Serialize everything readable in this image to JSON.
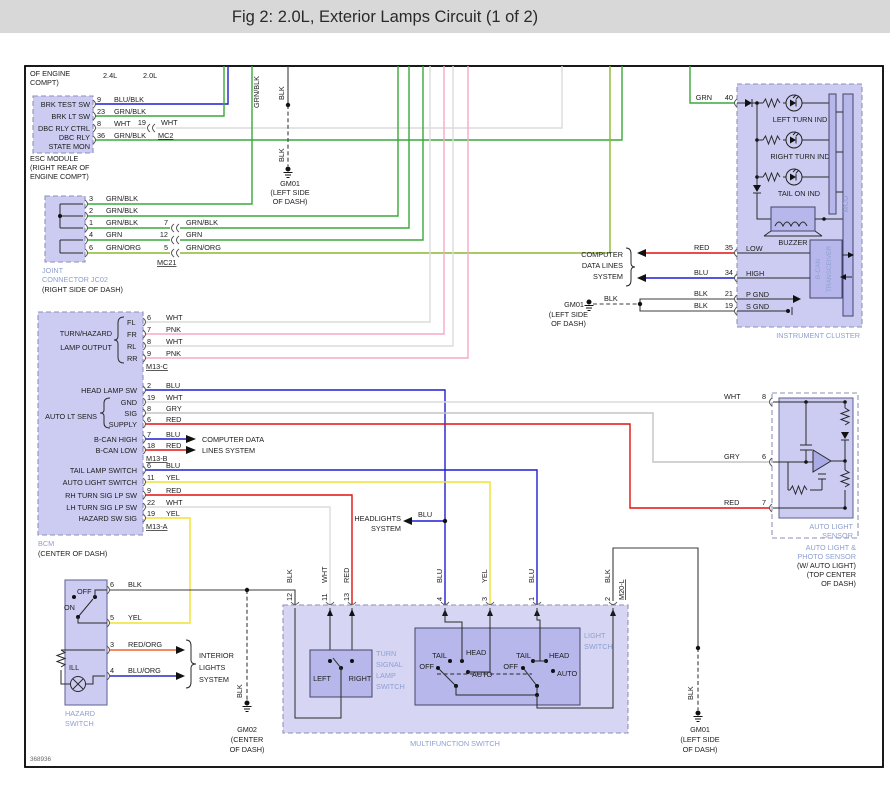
{
  "header": {
    "title": "Fig 2: 2.0L, Exterior Lamps Circuit (1 of 2)"
  },
  "footer": {
    "figure_id": "368936"
  },
  "colors": {
    "header_bar": "#d8d8d8",
    "component_fill": "#ccccf2",
    "component_inner_fill": "#b7b7ec",
    "component_name_text": "#8d9fd1",
    "wire_green": "#3aa83a",
    "wire_blue": "#1f1fd0",
    "wire_red": "#e01010",
    "wire_yellow": "#f0e232",
    "wire_pink": "#f5a8c8",
    "wire_white": "#dcdcdc",
    "wire_gray": "#c3c3c3",
    "wire_black": "#3c3c3c",
    "wire_red_org": "#f06028",
    "wire_blu_org": "#2828c8",
    "wire_grn_org": "#8ab82e"
  },
  "esc": {
    "note_l1": "OF ENGINE",
    "note_l2": "COMPT)",
    "variant_24": "2.4L",
    "variant_20": "2.0L",
    "labels": [
      "BRK TEST SW",
      "BRK LT SW",
      "DBC RLY CTRL",
      "DBC RLY",
      "STATE MON"
    ],
    "pins": [
      {
        "num": "9",
        "wire": "BLU/BLK"
      },
      {
        "num": "23",
        "wire": "GRN/BLK"
      },
      {
        "num": "8",
        "wire": "WHT"
      },
      {
        "num": "36",
        "wire": "GRN/BLK"
      }
    ],
    "mc2": {
      "num": "19",
      "wire": "WHT",
      "label": "MC2"
    },
    "name_l1": "ESC MODULE",
    "name_l2": "(RIGHT REAR OF",
    "name_l3": "ENGINE COMPT)"
  },
  "top_gm01": {
    "wire1": "BLK",
    "wire2": "BLK",
    "name": "GM01",
    "loc1": "(LEFT SIDE",
    "loc2": "OF DASH)"
  },
  "top_vert_label": "GRN/BLK",
  "jc02": {
    "pins": [
      {
        "num": "3",
        "wire": "GRN/BLK"
      },
      {
        "num": "2",
        "wire": "GRN/BLK"
      },
      {
        "num": "1",
        "wire": "GRN/BLK"
      },
      {
        "num": "4",
        "wire": "GRN"
      },
      {
        "num": "6",
        "wire": "GRN/ORG"
      }
    ],
    "mc21": [
      {
        "num": "7",
        "wire": "GRN/BLK"
      },
      {
        "num": "12",
        "wire": "GRN"
      },
      {
        "num": "5",
        "wire": "GRN/ORG"
      }
    ],
    "mc21_label": "MC21",
    "name_l1": "JOINT",
    "name_l2": "CONNECTOR JC02",
    "loc": "(RIGHT SIDE OF DASH)"
  },
  "bcm": {
    "turn_l1": "TURN/HAZARD",
    "turn_l2": "LAMP OUTPUT",
    "turn_rows": [
      {
        "pos": "FL",
        "num": "6",
        "wire": "WHT"
      },
      {
        "pos": "FR",
        "num": "7",
        "wire": "PNK"
      },
      {
        "pos": "RL",
        "num": "8",
        "wire": "WHT"
      },
      {
        "pos": "RR",
        "num": "9",
        "wire": "PNK"
      }
    ],
    "m13c": "M13-C",
    "m13b": "M13-B",
    "m13a": "M13-A",
    "head": {
      "label": "HEAD LAMP SW",
      "num": "2",
      "wire": "BLU"
    },
    "auto_label": "AUTO LT SENS",
    "auto_rows": [
      {
        "pos": "GND",
        "num": "19",
        "wire": "WHT"
      },
      {
        "pos": "SIG",
        "num": "8",
        "wire": "GRY"
      },
      {
        "pos": "SUPPLY",
        "num": "6",
        "wire": "RED"
      }
    ],
    "bcan_rows": [
      {
        "label": "B-CAN HIGH",
        "num": "7",
        "wire": "BLU"
      },
      {
        "label": "B-CAN LOW",
        "num": "18",
        "wire": "RED"
      }
    ],
    "low_rows": [
      {
        "label": "TAIL LAMP SWITCH",
        "num": "6",
        "wire": "BLU"
      },
      {
        "label": "AUTO LIGHT SWITCH",
        "num": "11",
        "wire": "YEL"
      },
      {
        "label": "RH TURN SIG LP SW",
        "num": "9",
        "wire": "RED"
      },
      {
        "label": "LH TURN SIG LP SW",
        "num": "22",
        "wire": "WHT"
      },
      {
        "label": "HAZARD SW SIG",
        "num": "19",
        "wire": "YEL"
      }
    ],
    "name": "BCM",
    "loc": "(CENTER OF DASH)"
  },
  "refs": {
    "cd_l1": "COMPUTER DATA",
    "cd_l2": "LINES SYSTEM",
    "cdl_l1": "COMPUTER",
    "cdl_l2": "DATA LINES",
    "cdl_l3": "SYSTEM",
    "hl_l1": "HEADLIGHTS",
    "hl_l2": "SYSTEM",
    "hl_wire": "BLU",
    "int_l1": "INTERIOR",
    "int_l2": "LIGHTS",
    "int_l3": "SYSTEM"
  },
  "cluster": {
    "feed_wire": "GRN",
    "feed_num": "40",
    "ind": [
      "LEFT TURN IND",
      "RIGHT TURN IND",
      "TAIL ON IND"
    ],
    "buzzer": "BUZZER",
    "mcu": "MCU",
    "bt_l1": "B-CAN",
    "bt_l2": "TRANSCEIVER",
    "rows": [
      {
        "wire": "RED",
        "num": "35",
        "label": "LOW"
      },
      {
        "wire": "BLU",
        "num": "34",
        "label": "HIGH"
      },
      {
        "wire": "BLK",
        "num": "21",
        "label": "P GND"
      },
      {
        "wire": "BLK",
        "num": "19",
        "label": "S GND"
      }
    ],
    "name": "INSTRUMENT CLUSTER",
    "gm01": {
      "wire": "BLK",
      "name": "GM01",
      "loc1": "(LEFT SIDE",
      "loc2": "OF DASH)"
    }
  },
  "sensor": {
    "rows": [
      {
        "wire": "WHT",
        "num": "8"
      },
      {
        "wire": "GRY",
        "num": "6"
      },
      {
        "wire": "RED",
        "num": "7"
      }
    ],
    "name_l1": "AUTO LIGHT",
    "name_l2": "SENSOR",
    "out_l1": "AUTO LIGHT &",
    "out_l2": "PHOTO SENSOR",
    "out_l3": "(W/ AUTO LIGHT)",
    "out_l4": "(TOP CENTER",
    "out_l5": "OF DASH)"
  },
  "hazard": {
    "pins": [
      {
        "num": "6",
        "wire": "BLK"
      },
      {
        "num": "5",
        "wire": "YEL"
      },
      {
        "num": "3",
        "wire": "RED/ORG"
      },
      {
        "num": "4",
        "wire": "BLU/ORG"
      }
    ],
    "on": "ON",
    "off": "OFF",
    "ill": "ILL",
    "name_l1": "HAZARD",
    "name_l2": "SWITCH"
  },
  "mfs": {
    "pins": [
      {
        "num": "12",
        "wire": "BLK"
      },
      {
        "num": "11",
        "wire": "WHT"
      },
      {
        "num": "13",
        "wire": "RED"
      },
      {
        "num": "4",
        "wire": "BLU"
      },
      {
        "num": "3",
        "wire": "YEL"
      },
      {
        "num": "1",
        "wire": "BLU"
      },
      {
        "num": "2",
        "wire": "BLK"
      }
    ],
    "m20l": "M20-L",
    "turn": {
      "l1": "TURN",
      "l2": "SIGNAL",
      "l3": "LAMP",
      "l4": "SWITCH",
      "left": "LEFT",
      "right": "RIGHT"
    },
    "light": {
      "l1": "LIGHT",
      "l2": "SWITCH"
    },
    "sw1": {
      "off": "OFF",
      "tail": "TAIL",
      "head": "HEAD",
      "auto": "AUTO"
    },
    "sw2": {
      "off": "OFF",
      "tail": "TAIL",
      "head": "HEAD",
      "auto": "AUTO"
    },
    "name": "MULTIFUNCTION SWITCH"
  },
  "gm02": {
    "wire": "BLK",
    "name": "GM02",
    "loc1": "(CENTER",
    "loc2": "OF DASH)"
  },
  "gm01b": {
    "wire": "BLK",
    "name": "GM01",
    "loc1": "(LEFT SIDE",
    "loc2": "OF DASH)"
  }
}
